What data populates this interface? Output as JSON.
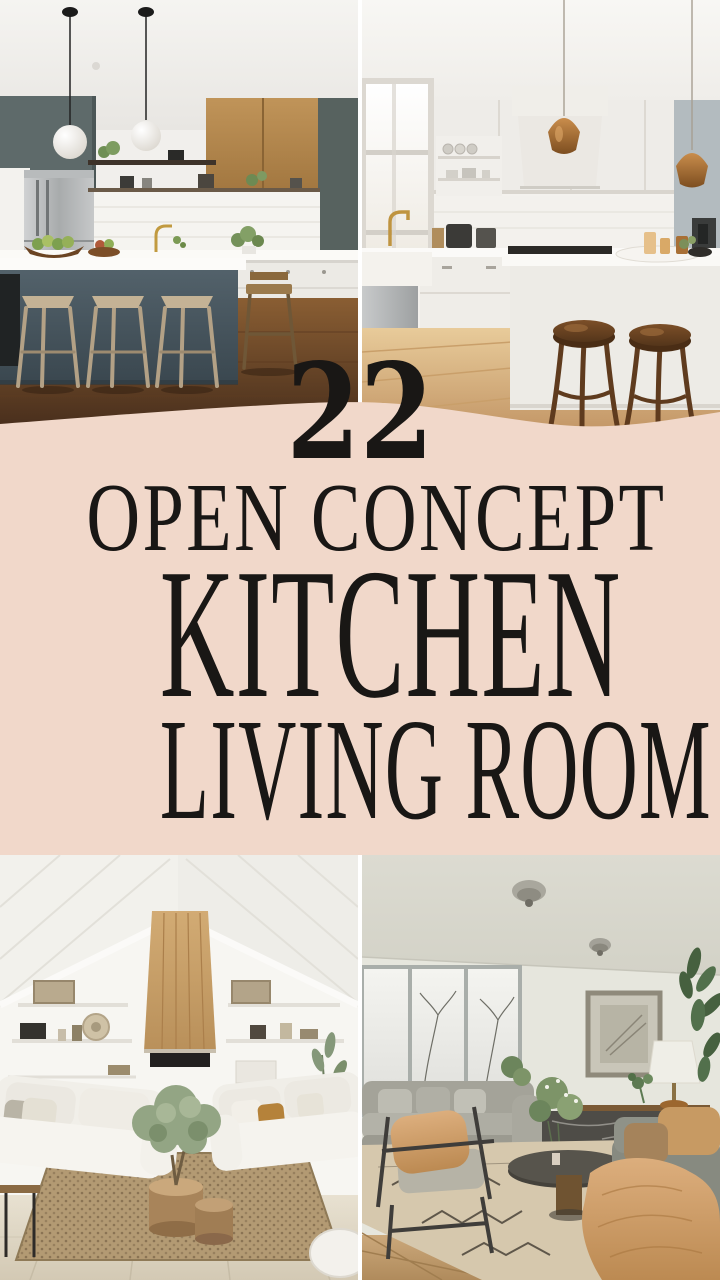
{
  "poster": {
    "badge_count": "22",
    "headline_line1": "OPEN CONCEPT",
    "headline_line2": "KITCHEN",
    "headline_line3": "LIVING ROOM"
  },
  "style": {
    "banner_background": "#f1d8ca",
    "headline_color": "#191715",
    "page_background": "#ffffff"
  },
  "photos": [
    {
      "position": "top-left",
      "subject": "modern-kitchen-dark-island-wood-stools"
    },
    {
      "position": "top-right",
      "subject": "white-kitchen-copper-pendants-round-stools"
    },
    {
      "position": "bottom-left",
      "subject": "vaulted-white-living-room-wood-fireplace"
    },
    {
      "position": "bottom-right",
      "subject": "gray-living-room-winter-windows-tan-throw"
    }
  ]
}
